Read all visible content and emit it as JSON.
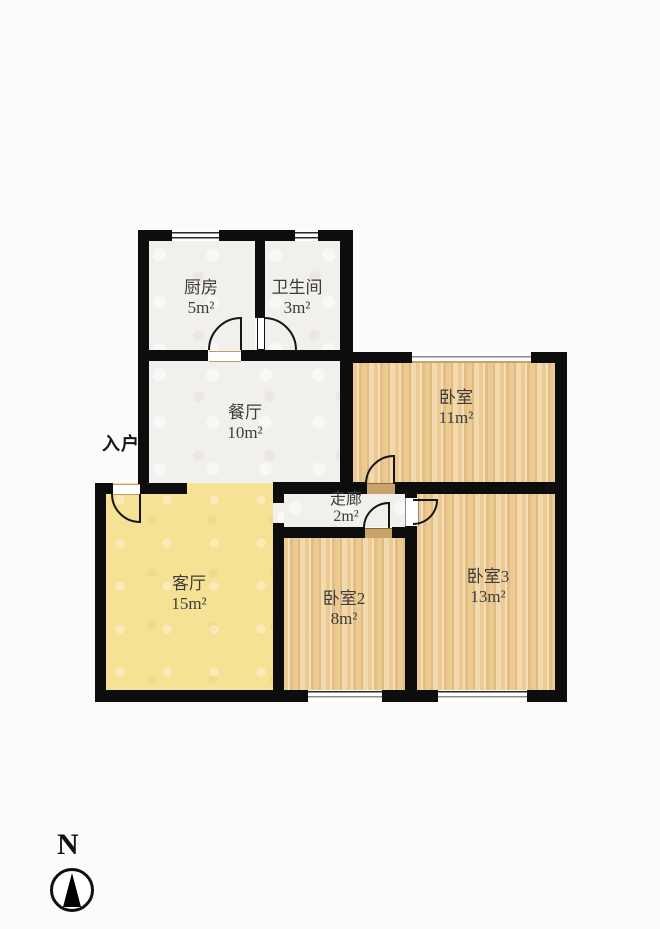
{
  "floorplan": {
    "entrance": {
      "label": "入户"
    },
    "compass": {
      "label": "N"
    },
    "rooms": {
      "kitchen": {
        "name": "厨房",
        "area": "5m²"
      },
      "bathroom": {
        "name": "卫生间",
        "area": "3m²"
      },
      "dining": {
        "name": "餐厅",
        "area": "10m²"
      },
      "bedroom1": {
        "name": "卧室",
        "area": "11m²"
      },
      "corridor": {
        "name": "走廊",
        "area": "2m²"
      },
      "living": {
        "name": "客厅",
        "area": "15m²"
      },
      "bedroom2": {
        "name": "卧室2",
        "area": "8m²"
      },
      "bedroom3": {
        "name": "卧室3",
        "area": "13m²"
      }
    },
    "colors": {
      "wall": "#0d0d0d",
      "tile": "#f2f0ed",
      "wood": "#ecca92",
      "living": "#f6e294"
    }
  }
}
